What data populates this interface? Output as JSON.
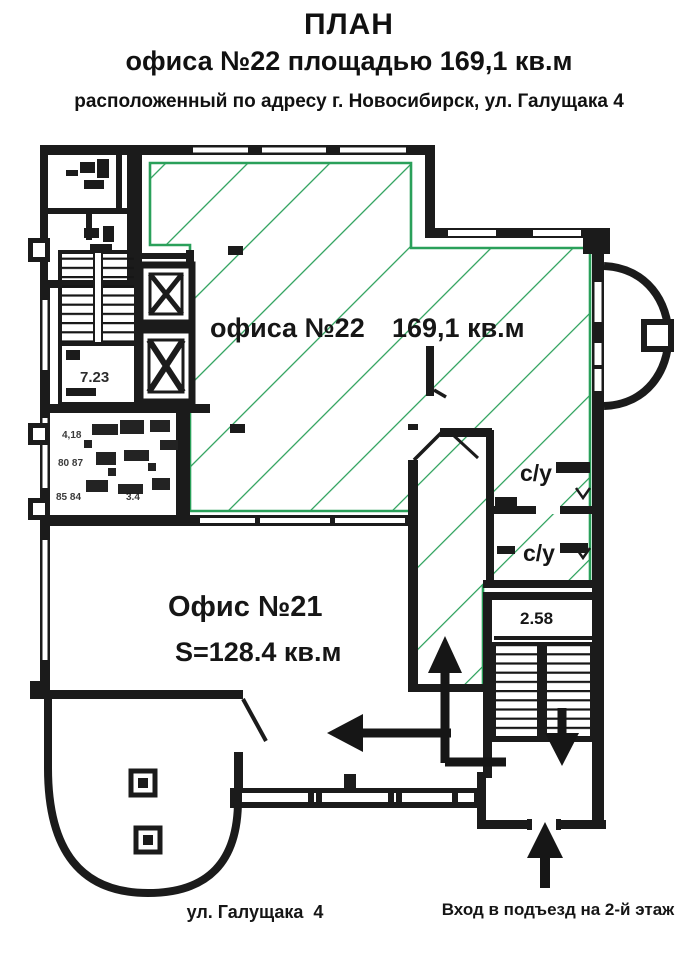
{
  "title": {
    "line1": "ПЛАН",
    "line2": "офиса №22 площадью 169,1 кв.м",
    "line3": "расположенный по адресу г. Новосибирск, ул. Галущака 4"
  },
  "plan": {
    "office22": {
      "name_label": "офиса №22",
      "area_label": "169,1 кв.м",
      "outline_color": "#2aa05a"
    },
    "office21": {
      "name_label": "Офис №21",
      "area_label": "S=128.4 кв.м"
    },
    "bathrooms": {
      "label_top": "с/у",
      "label_bottom": "с/у"
    },
    "stairs": {
      "entrance_stair_label": "2.58",
      "core_landing_label": "7.23"
    },
    "scan_artifacts": {
      "a1": "4,18",
      "a2": "80 87",
      "a3": "85 84",
      "a4": "3.4"
    },
    "street_label": "ул. Галущака  4",
    "entrance_label": "Вход в подъезд на 2-й этаж"
  }
}
